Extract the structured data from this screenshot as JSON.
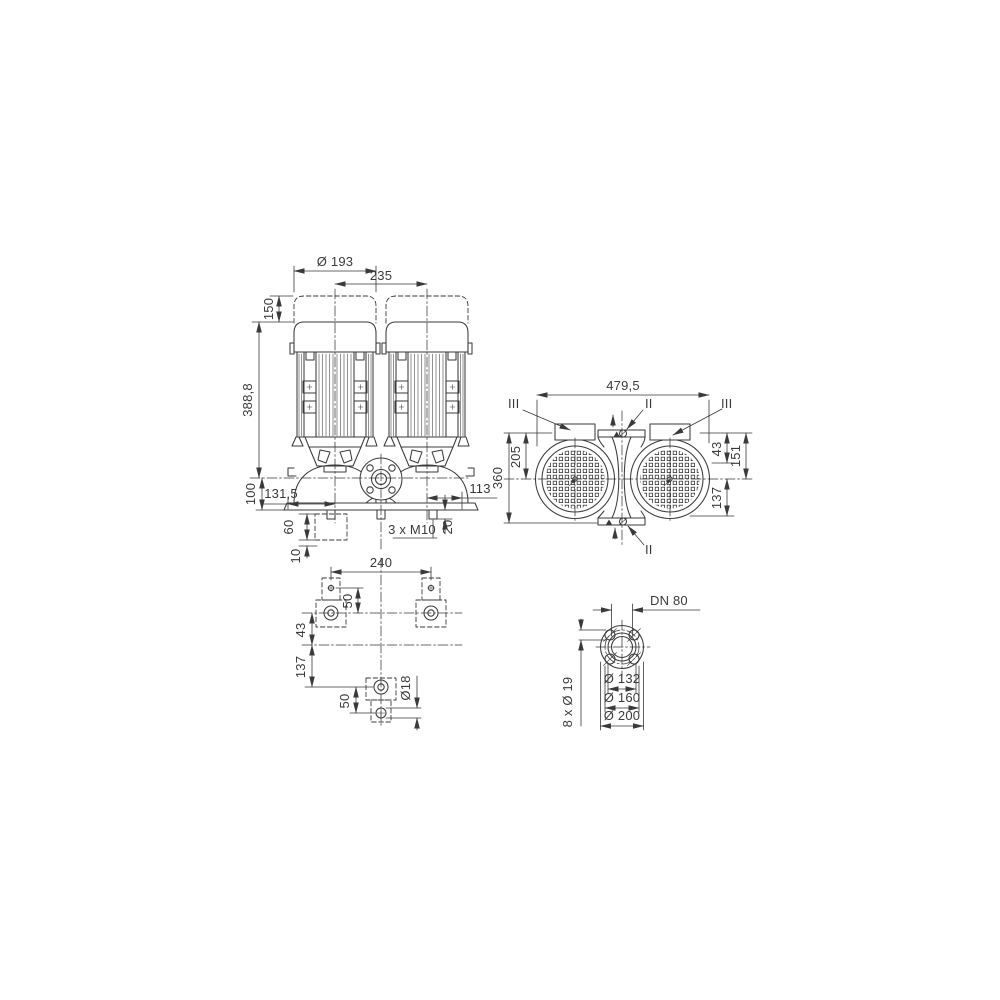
{
  "meta": {
    "line_color": "#3a3a3a",
    "background": "#ffffff",
    "drawing_type": "dimensional drawing, twin in-line pump"
  },
  "front_view": {
    "dims": {
      "motor_diameter": "Ø 193",
      "motor_spacing": "235",
      "dismantling_clearance": "150",
      "height_to_axis": "388,8",
      "axis_to_base": "100",
      "offset_left": "131,5",
      "foundation_height": "60",
      "grout_thickness": "10",
      "offset_right": "113",
      "stud_protrusion": "20",
      "stud_thread": "3 x M10"
    }
  },
  "top_view": {
    "dims": {
      "overall_width": "479,5",
      "overall_depth": "360",
      "axis_to_front": "205",
      "flange_offset": "43",
      "axis_to_back_edge": "151",
      "axis_to_back": "137"
    },
    "labels": {
      "section_iii_left": "III",
      "section_ii_top": "II",
      "section_iii_right": "III",
      "section_ii_bottom": "II"
    }
  },
  "foundation_plan": {
    "dims": {
      "bolt_span": "240",
      "hole_pitch_top": "50",
      "row_spacing": "43",
      "row_to_bolt": "137",
      "hole_pitch_bottom": "50",
      "hole_diameter": "Ø18"
    }
  },
  "flange_view": {
    "labels": {
      "nominal": "DN 80",
      "bolt_holes": "8 x Ø 19"
    },
    "dims": {
      "raised_face": "Ø 132",
      "bolt_circle": "Ø 160",
      "outer_diameter": "Ø 200"
    }
  }
}
